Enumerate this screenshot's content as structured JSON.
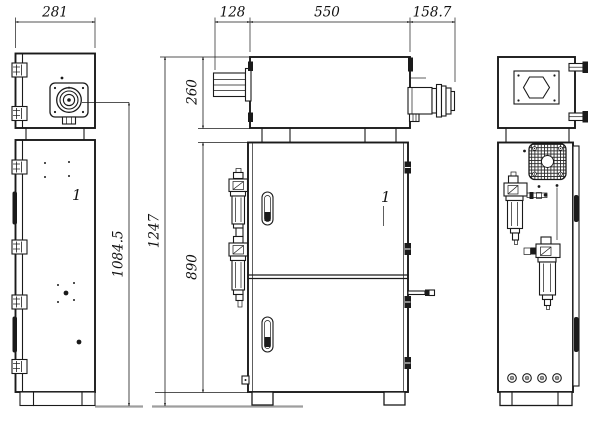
{
  "dimensions": {
    "left_view_width": "281",
    "top_box_offset": "128",
    "top_box_width": "550",
    "connector_length": "158.7",
    "top_box_height": "260",
    "connector_axis_height": "1084.5",
    "overall_height": "1247",
    "cabinet_height": "890"
  },
  "callouts": {
    "left_item": "1",
    "front_item": "1"
  },
  "colors": {
    "line": "#1a1a1a",
    "ground": "#9e9e9e",
    "background": "#ffffff"
  }
}
